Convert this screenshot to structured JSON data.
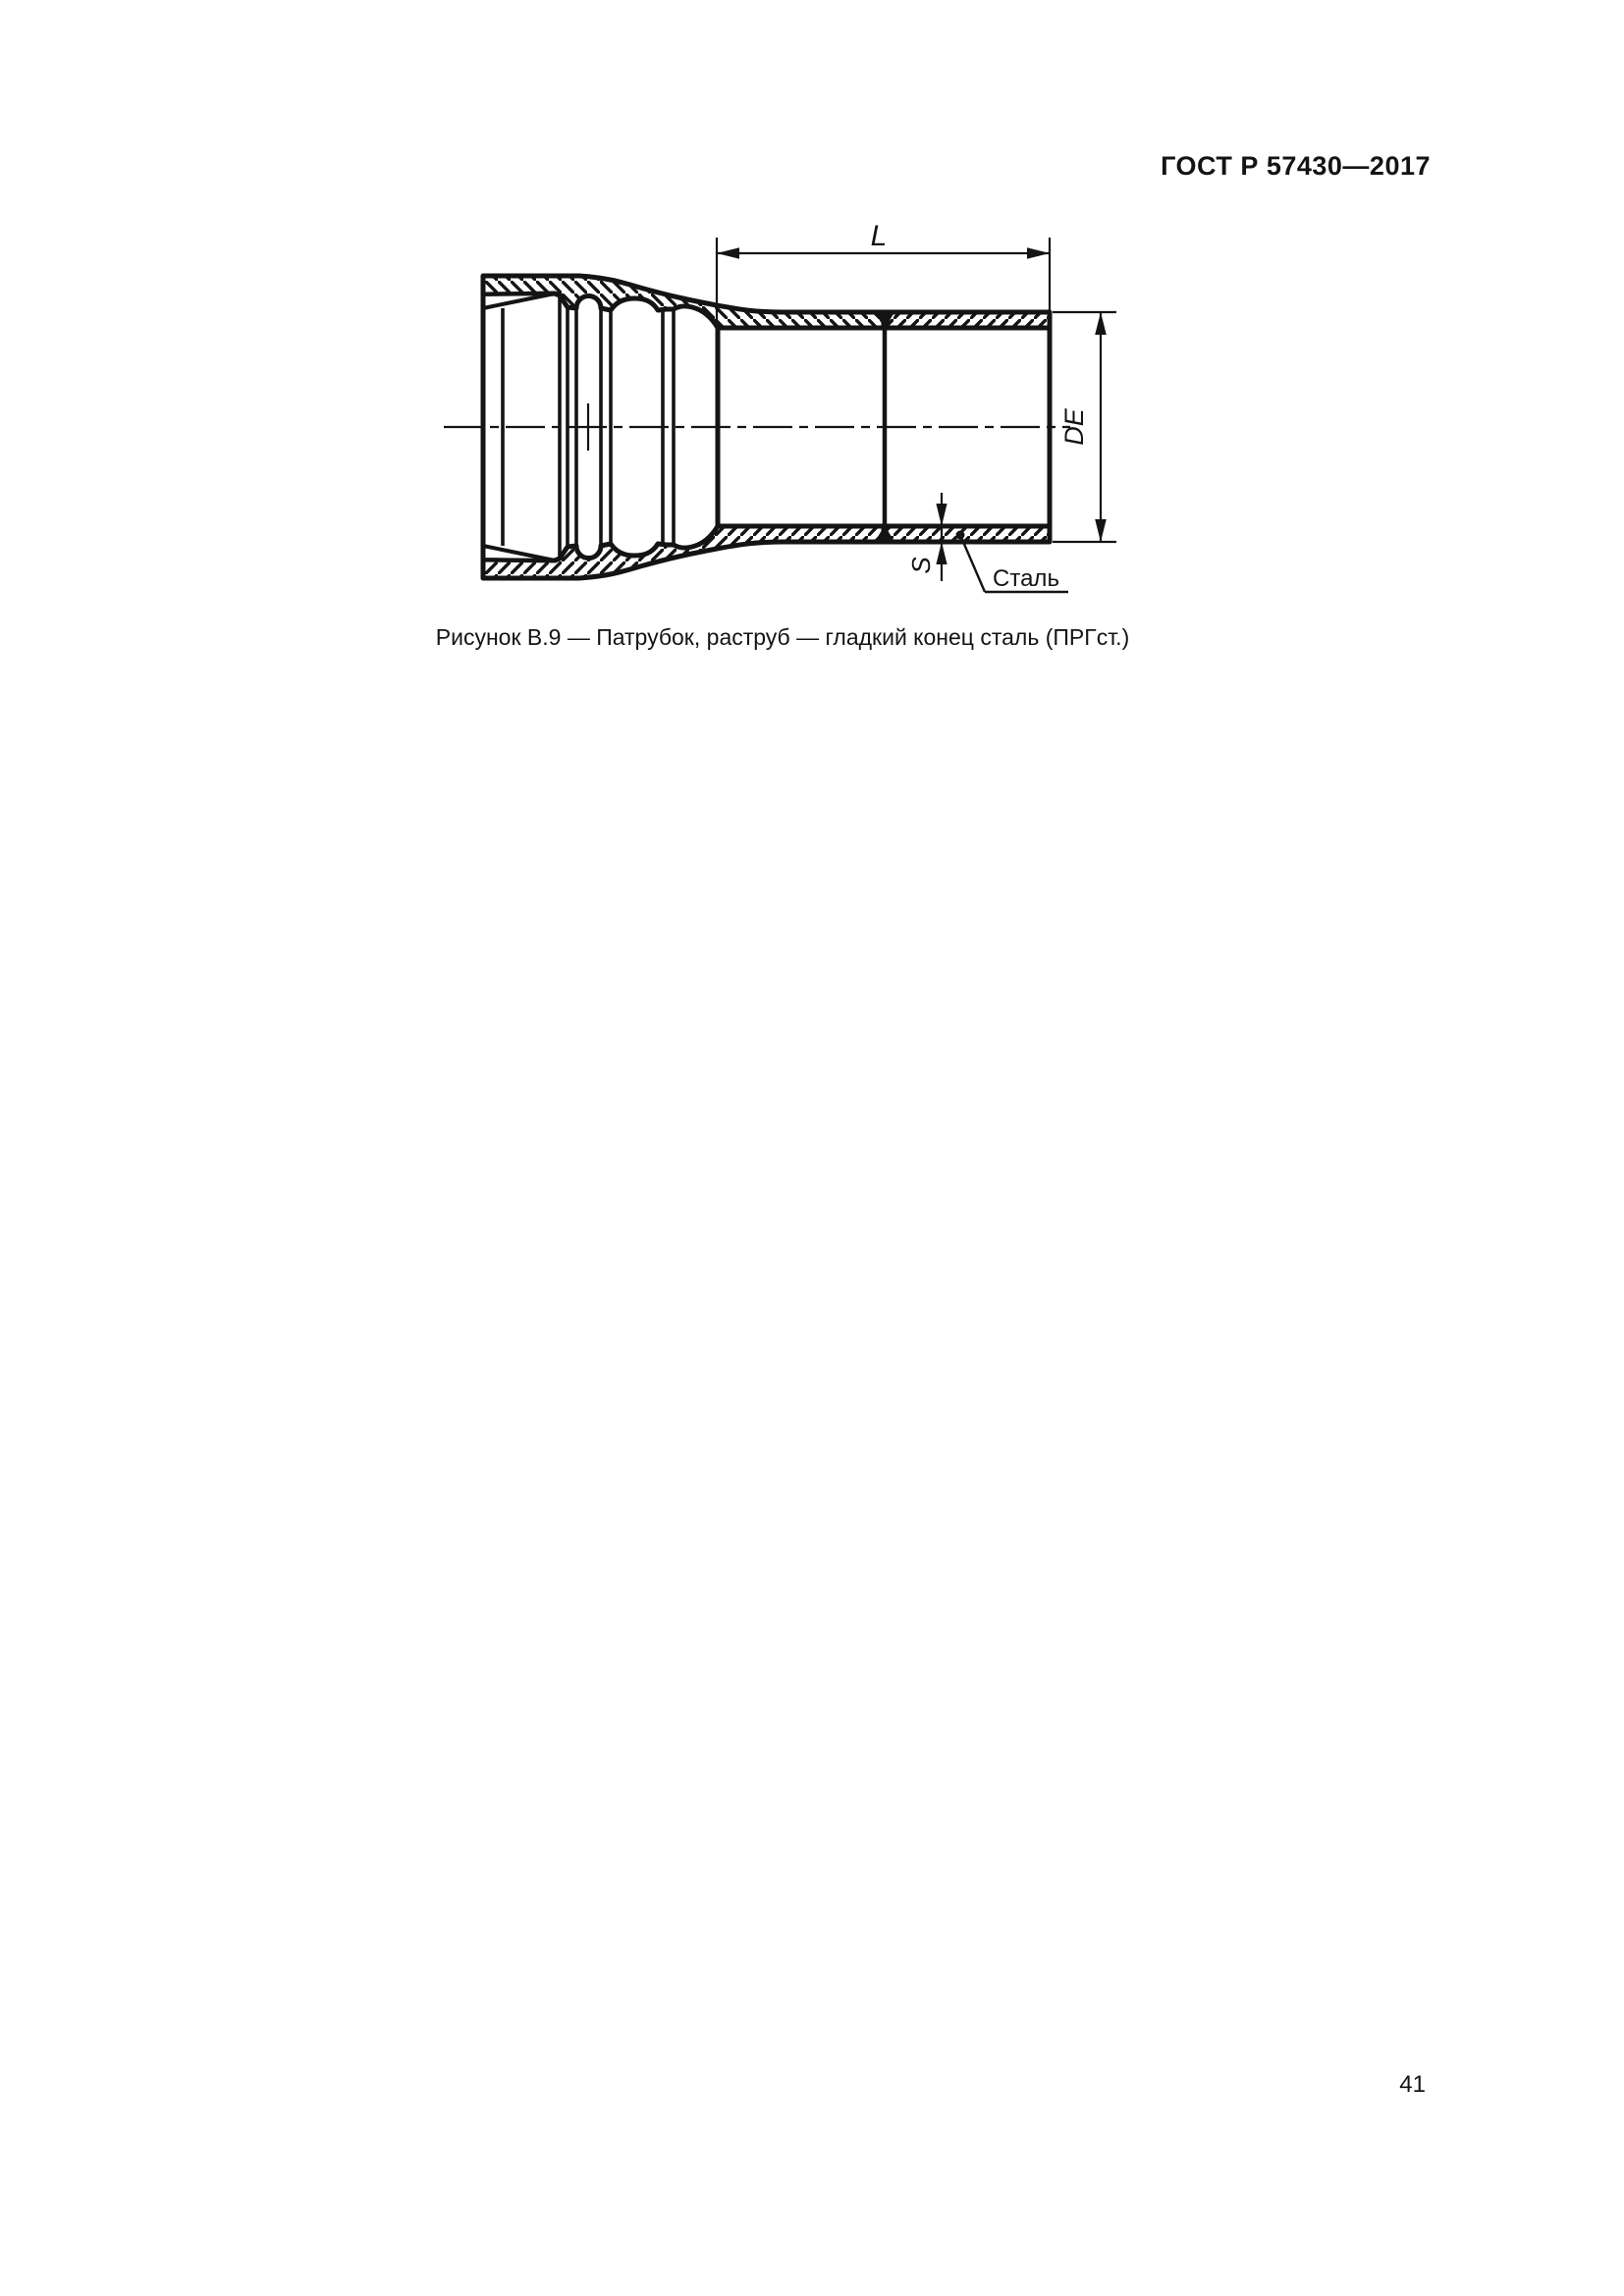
{
  "page": {
    "header_title": "ГОСТ Р 57430—2017",
    "page_number": "41",
    "paper_color": "#ffffff",
    "ink_color": "#141414"
  },
  "figure": {
    "caption": "Рисунок В.9 — Патрубок, раструб — гладкий конец сталь (ПРГст.)",
    "dimensions": {
      "length_label": "L",
      "outer_diameter_label": "DE",
      "wall_thickness_label": "S"
    },
    "material_callout": "Сталь"
  }
}
